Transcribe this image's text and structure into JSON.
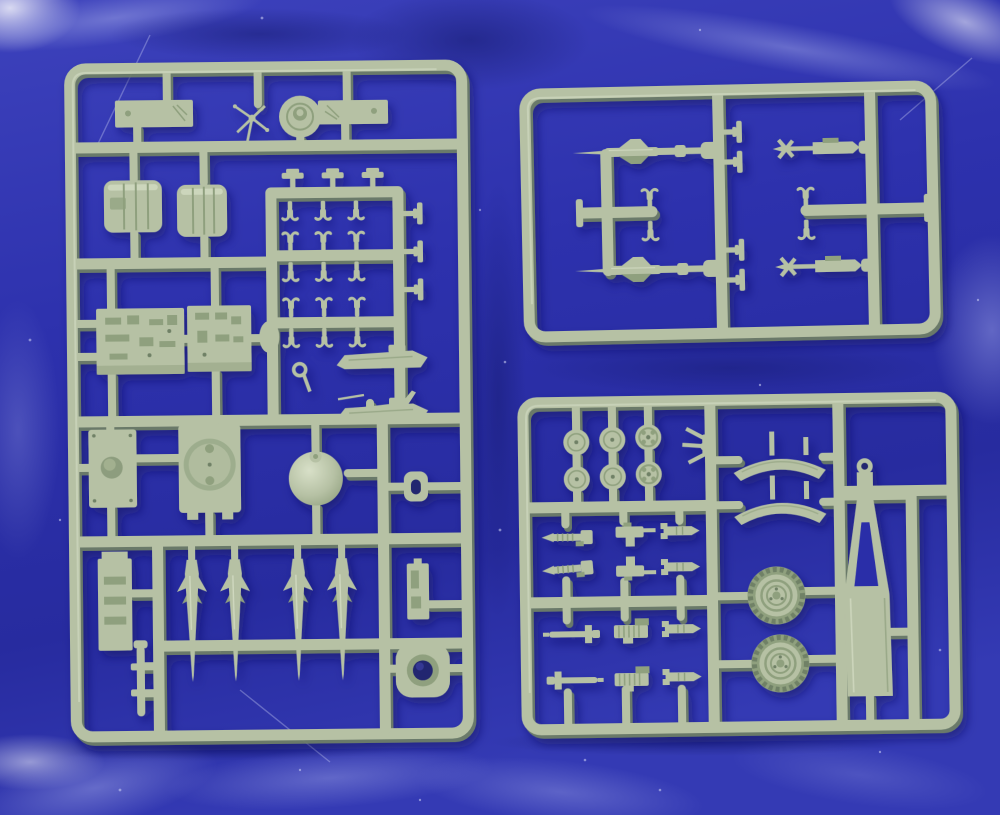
{
  "scene": {
    "type": "photograph",
    "description": "Photograph of three sage-green injection-moulded plastic model-kit sprues (part trees) laid on creased royal-blue fabric. A large rectangular sprue fills the left half; a smaller sprue with four missile bodies sits top-right; a sprue with wheels, fenders and a trailer A-frame sits bottom-right.",
    "background": "royal blue creased cloth with small lint specks and light folds",
    "material": "matte sage-green styrene plastic",
    "sprues": [
      {
        "id": "large-left",
        "position": "left",
        "contents": [
          {
            "part": "flat mounting bar",
            "count": 2
          },
          {
            "part": "hand-wheel linkage",
            "count": 1
          },
          {
            "part": "round pulley disc",
            "count": 1
          },
          {
            "part": "ribbed storage drum",
            "count": 2
          },
          {
            "part": "tie-down clamp",
            "count": 15
          },
          {
            "part": "t-bracket clip",
            "count": 6
          },
          {
            "part": "detailed chassis plate",
            "count": 2
          },
          {
            "part": "hatch plate with port hole",
            "count": 1
          },
          {
            "part": "ring plate with large opening",
            "count": 1
          },
          {
            "part": "dome",
            "count": 1
          },
          {
            "part": "shackle ring",
            "count": 1
          },
          {
            "part": "cradle rail",
            "count": 2
          },
          {
            "part": "tail boom",
            "count": 1
          },
          {
            "part": "finned missile",
            "count": 4
          },
          {
            "part": "ladder bracket",
            "count": 1
          },
          {
            "part": "axle rod with crossbars",
            "count": 1
          },
          {
            "part": "latch bracket",
            "count": 1
          },
          {
            "part": "base plate with hole",
            "count": 1
          }
        ]
      },
      {
        "id": "top-right",
        "position": "upper right",
        "contents": [
          {
            "part": "finned missile",
            "count": 2
          },
          {
            "part": "small rocket launcher",
            "count": 2
          },
          {
            "part": "tie-down clamp",
            "count": 4
          },
          {
            "part": "t-bracket clip",
            "count": 4
          },
          {
            "part": "runner end cap",
            "count": 2
          }
        ]
      },
      {
        "id": "bottom-right",
        "position": "lower right",
        "contents": [
          {
            "part": "road wheel disc",
            "count": 6
          },
          {
            "part": "treaded rubber wheel",
            "count": 2
          },
          {
            "part": "curved fender",
            "count": 2
          },
          {
            "part": "trailer A-frame with tow eye",
            "count": 1
          },
          {
            "part": "three-prong bracket",
            "count": 1
          },
          {
            "part": "small fitting (exhausts, guns, axles, rockets)",
            "count": 12
          }
        ]
      }
    ]
  },
  "colors": {
    "fabric_base": "#2e33b2",
    "fabric_deep": "#20249a",
    "fabric_highlight": "#aeb3ea",
    "fabric_bright": "#dfe3fa",
    "fabric_shadow": "#161b72",
    "plastic": "#b6c1a4",
    "plastic_highlight": "#d6dec6",
    "plastic_shadow": "#8fa07e",
    "plastic_dark": "#6f8166",
    "hole_shadow": "#232770",
    "cast_shadow": "#0e1060"
  }
}
